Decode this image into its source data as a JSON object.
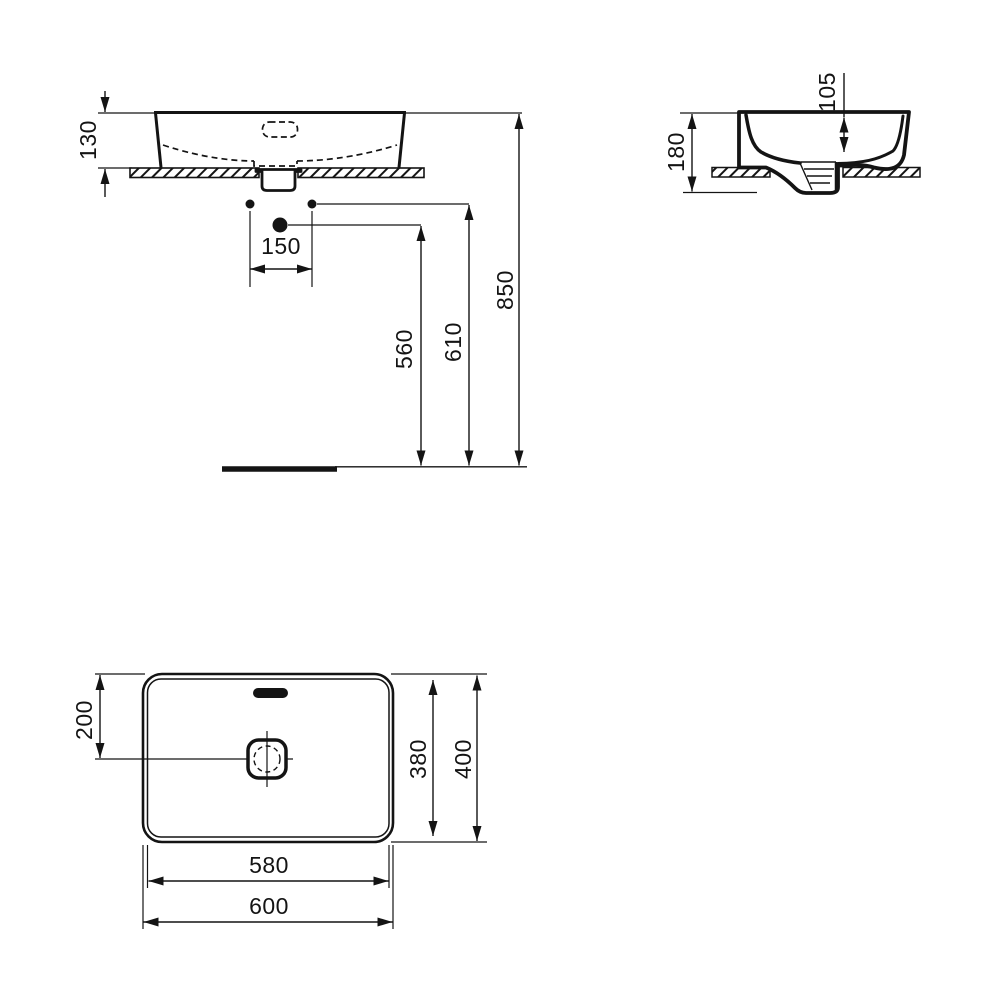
{
  "drawing": {
    "ink": "#141414",
    "background": "#ffffff",
    "views": {
      "front": {
        "dims": {
          "basin_height_above_counter": "130",
          "tap_hole_spacing": "150",
          "drain_height": "560",
          "inlet_height": "610",
          "rim_height": "850"
        }
      },
      "side": {
        "dims": {
          "total_height": "180",
          "bowl_depth": "105"
        }
      },
      "plan": {
        "dims": {
          "drain_center_offset": "200",
          "inner_width": "380",
          "outer_width": "400",
          "inner_length": "580",
          "outer_length": "600"
        }
      }
    }
  }
}
